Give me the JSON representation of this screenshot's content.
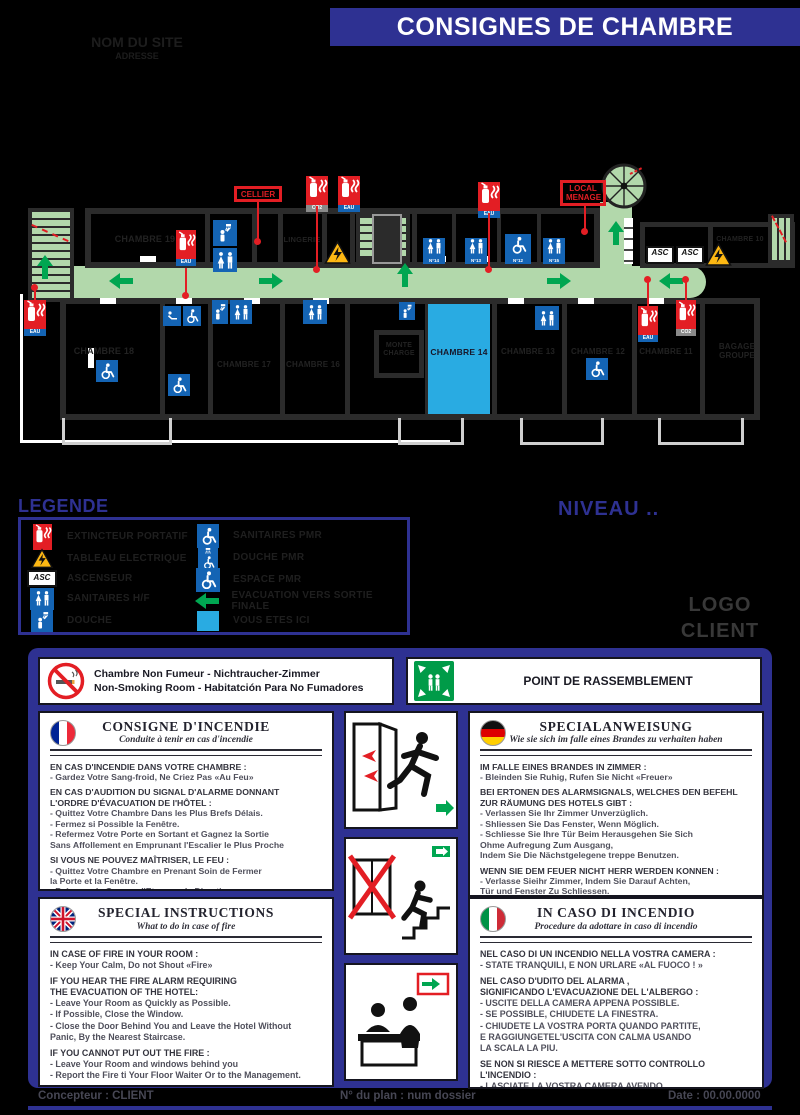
{
  "header": {
    "title": "CONSIGNES DE CHAMBRE",
    "site_name": "NOM DU SITE",
    "site_address": "ADRESSE"
  },
  "plan": {
    "rooms": {
      "r19": "CHAMBRE 19",
      "r18": "CHAMBRE 18",
      "r17": "CHAMBRE 17",
      "r16": "CHAMBRE 16",
      "r14": "CHAMBRE 14",
      "r13": "CHAMBRE 13",
      "r12": "CHAMBRE 12",
      "r11": "CHAMBRE 11",
      "r10": "CHAMBRE 10",
      "lingerie": "LINGERIE",
      "bagage": "BAGAGE\nGROUPE",
      "monte": "MONTE\nCHARGE"
    },
    "red_labels": {
      "cellier": "CELLIER",
      "local_menage": "LOCAL\nMENAGE"
    },
    "asc": "ASC",
    "ext": {
      "eau": "EAU",
      "co2": "CO2"
    },
    "wc_numbers": [
      "N°14",
      "N°13",
      "N°12",
      "N°15"
    ]
  },
  "legend": {
    "title": "LEGENDE",
    "left": [
      "EXTINCTEUR PORTATIF",
      "TABLEAU ELECTRIQUE",
      "ASCENSEUR",
      "SANITAIRES H/F",
      "DOUCHE"
    ],
    "right": [
      "SANITAIRES PMR",
      "DOUCHE PMR",
      "ESPACE PMR",
      "EVACUATION VERS SORTIE FINALE",
      "VOUS ETES ICI"
    ]
  },
  "niveau": "NIVEAU ..",
  "logo": "LOGO\nCLIENT",
  "notices": {
    "smoking": "Chambre Non Fumeur - Nichtraucher-Zimmer\nNon-Smoking Room    - Habitatción Para No Fumadores",
    "assembly": "POINT DE RASSEMBLEMENT"
  },
  "cards": {
    "fr": {
      "title": "CONSIGNE D'INCENDIE",
      "subtitle": "Conduite à tenir en cas d'incendie",
      "h0": "EN CAS D'INCENDIE DANS VOTRE CHAMBRE :",
      "b0": "- Gardez Votre Sang-froid, Ne Criez Pas «Au Feu»",
      "h1": "EN CAS D'AUDITION DU SIGNAL D'ALARME DONNANT\nL'ORDRE D'ÉVACUATION DE l'HÔTEL :",
      "b1": "- Quittez Votre Chambre Dans les Plus Brefs Délais.\n- Fermez si Possible la Fenêtre.\n- Refermez Votre Porte en Sortant et Gagnez la Sortie\nSans Affollement en Emprunant l'Escalier le Plus Proche",
      "h2": "SI VOUS NE POUVEZ MAÎTRISER, LE FEU :",
      "b2": "- Quittez Votre Chambre en Prenant Soin de Fermer\nla Porte et la Fenêtre.\n- Prévenez le Garçon d'Etage ou la Direction."
    },
    "de": {
      "title": "SPECIALANWEISUNG",
      "subtitle": "Wie sie sich im falle eines Brandes zu verhaiten haben",
      "h0": "IM FALLE EINES BRANDES IN ZIMMER :",
      "b0": "- Bleinden Sie Ruhig, Rufen Sie Nicht «Freuer»",
      "h1": "BEI ERTONEN DES ALARMSIGNALS, WELCHES DEN BEFEHL\nZUR RÄUMUNG DES HOTELS GIBT :",
      "b1": "- Verlassen Sie Ihr Zimmer Unverzüglich.\n- Shliessen Sie Das Fenster, Wenn Möglich.\n- Schliesse Sie Ihre Tür Beim Herausgehen Sie Sich\nOhme Aufregung Zum Ausgang,\nIndem Sie Die Nächstgelegene treppe Benutzen.",
      "h2": "WENN SIE DEM FEUER NICHT HERR WERDEN KONNEN :",
      "b2": "- Verlasse Sieihr Zimmer, Indem Sie Darauf Achten,\nTür und Fenster Zu Schliessen.\n- Benachrichtigen Sie Den Etagendiener Oder\nDie Geschäfsleitung."
    },
    "en": {
      "title": "SPECIAL INSTRUCTIONS",
      "subtitle": "What to do in case of fire",
      "h0": "IN CASE OF FIRE IN YOUR ROOM :",
      "b0": "- Keep Your Calm, Do not Shout «Fire»",
      "h1": "IF YOU HEAR THE FIRE ALARM REQUIRING\nTHE EVACUATION OF THE HOTEL:",
      "b1": "- Leave Your Room as Quickly as Possible.\n- If Possible, Close the Window.\n- Close the Door Behind You and Leave the Hotel Without\nPanic, By the Nearest Staircase.",
      "h2": "IF YOU CANNOT PUT OUT THE FIRE :",
      "b2": "- Leave Your Room and windows behind you\n- Report the Fire ti Your Floor Waiter Or to the Management."
    },
    "it": {
      "title": "IN CASO DI INCENDIO",
      "subtitle": "Procedure da adottare in caso di incendio",
      "h0": "NEL CASO DI UN INCENDIO NELLA VOSTRA CAMERA :",
      "b0": "- STATE TRANQUILI, E NON URLARE «AL FUOCO ! »",
      "h1": "NEL CASO D'UDITO DEL ALARMA ,\nSIGNIFICANDO L'EVACUAZIONE DEL L'ALBERGO :",
      "b1": "- USCITE DELLA CAMERA APPENA POSSIBLE.\n- SE POSSIBLE, CHIUDETE LA FINESTRA.\n- CHIUDETE LA VOSTRA PORTA QUANDO PARTITE,\nE RAGGIUNGETEL'USCITA CON CALMA USANDO\nLA SCALA LA PIU.",
      "h2": "SE NON SI RIESCE A METTERE SOTTO CONTROLLO L'INCENDIO :",
      "b2": "- LASCIATE LA VOSTRA CAMERA AVENDO\nL'ACCORTEZZA DI CHIUDERE LA FINESTRA E LA PORTA.\n- AVVERTITE UN IMPIEGATO O LA DIREZIONE."
    }
  },
  "footer": {
    "designer": "Concepteur : CLIENT",
    "plan_no": "N° du plan : num dossier",
    "date": "Date : 00.00.0000"
  }
}
